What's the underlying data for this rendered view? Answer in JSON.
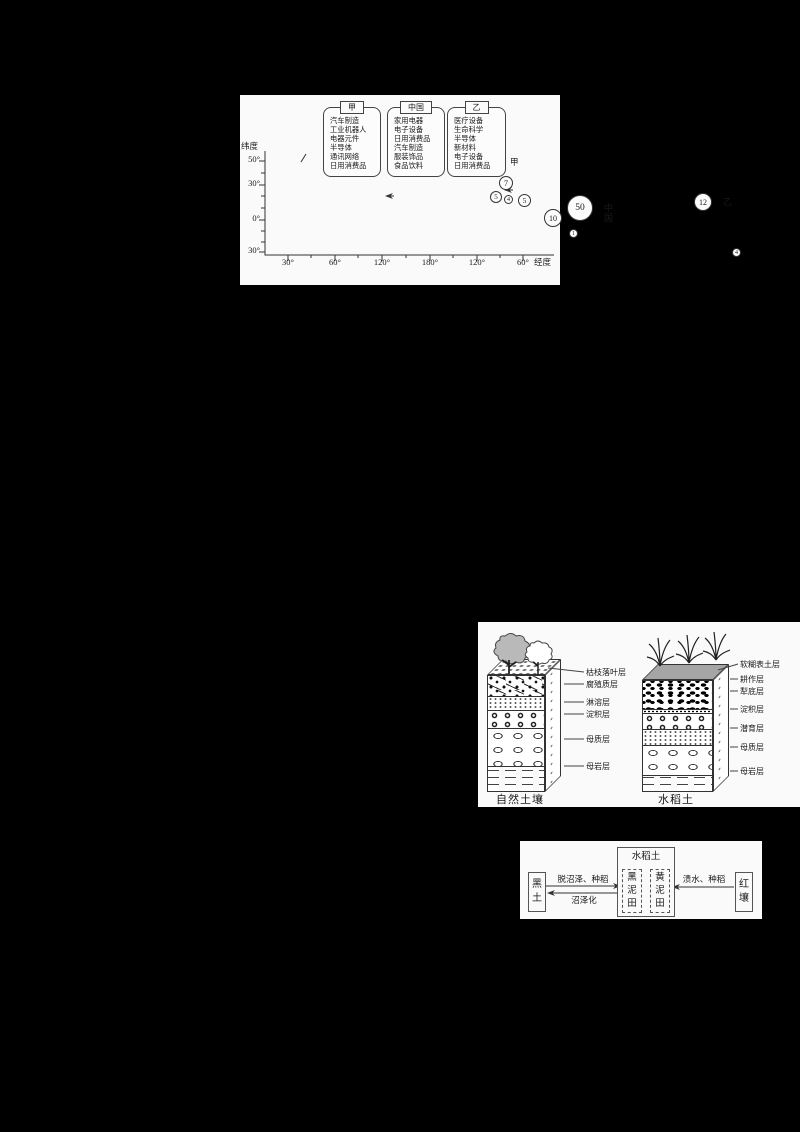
{
  "page_bg": "#000000",
  "panel_bg": "#fafafa",
  "line_color": "#333333",
  "panel1": {
    "y_axis_title": "纬度",
    "x_axis_title": "经度",
    "y_ticks": [
      "50°",
      "30°",
      "0°",
      "30°"
    ],
    "x_ticks": [
      "30°",
      "60°",
      "120°",
      "180°",
      "120°",
      "60°"
    ],
    "categories": [
      {
        "tab": "甲",
        "items": [
          "汽车制造",
          "工业机器人",
          "电器元件",
          "半导体",
          "通讯网络",
          "日用消费品"
        ]
      },
      {
        "tab": "中国",
        "items": [
          "家用电器",
          "电子设备",
          "日用消费品",
          "汽车制造",
          "服装饰品",
          "食品饮料"
        ]
      },
      {
        "tab": "乙",
        "items": [
          "医疗设备",
          "生命科学",
          "半导体",
          "新材料",
          "电子设备",
          "日用消费品"
        ]
      }
    ],
    "callouts": {
      "jia": "甲",
      "china": "中国",
      "yi": "乙"
    }
  },
  "chart_data": {
    "type": "scatter",
    "xlabel": "经度",
    "ylabel": "纬度",
    "x_tick_labels": [
      "30°",
      "60°",
      "120°",
      "180°",
      "120°",
      "60°"
    ],
    "y_tick_labels": [
      "50°",
      "30°",
      "0°",
      "30°"
    ],
    "legend_position": "top",
    "points": [
      {
        "value": "7",
        "callout": "甲",
        "lon_approx": "35°E",
        "lat_approx": "44°N"
      },
      {
        "value": "5",
        "callout": "",
        "lon_approx": "30°E",
        "lat_approx": "32°N"
      },
      {
        "value": "4",
        "callout": "",
        "lon_approx": "38°E",
        "lat_approx": "30°N"
      },
      {
        "value": "5",
        "callout": "",
        "lon_approx": "48°E",
        "lat_approx": "28°N"
      },
      {
        "value": "10",
        "callout": "",
        "lon_approx": "70°E",
        "lat_approx": "14°N"
      },
      {
        "value": "50",
        "callout": "中国",
        "lon_approx": "105°E",
        "lat_approx": "22°N"
      },
      {
        "value": "1",
        "callout": "",
        "lon_approx": "100°E",
        "lat_approx": "0°"
      },
      {
        "value": "12",
        "callout": "乙",
        "lon_approx": "95°W",
        "lat_approx": "27°N"
      },
      {
        "value": "4",
        "callout": "",
        "lon_approx": "50°W",
        "lat_approx": "17°S"
      }
    ]
  },
  "panel2": {
    "natural_soil": {
      "title": "自然土壤",
      "layers": [
        "枯枝落叶层",
        "腐殖质层",
        "淋溶层",
        "淀积层",
        "母质层",
        "母岩层"
      ]
    },
    "paddy_soil": {
      "title": "水稻土",
      "layers": [
        "软糊表土层",
        "耕作层",
        "犁底层",
        "淀积层",
        "潜育层",
        "母质层",
        "母岩层"
      ]
    }
  },
  "panel3": {
    "center_title": "水稻土",
    "inner_boxes": [
      "黑泥田",
      "黄泥田"
    ],
    "left_box": "黑土",
    "right_box": "红壤",
    "arrow_labels": {
      "top_left": "脱沼泽、种稻",
      "bottom_left": "沼泽化",
      "right": "渍水、种稻"
    }
  }
}
